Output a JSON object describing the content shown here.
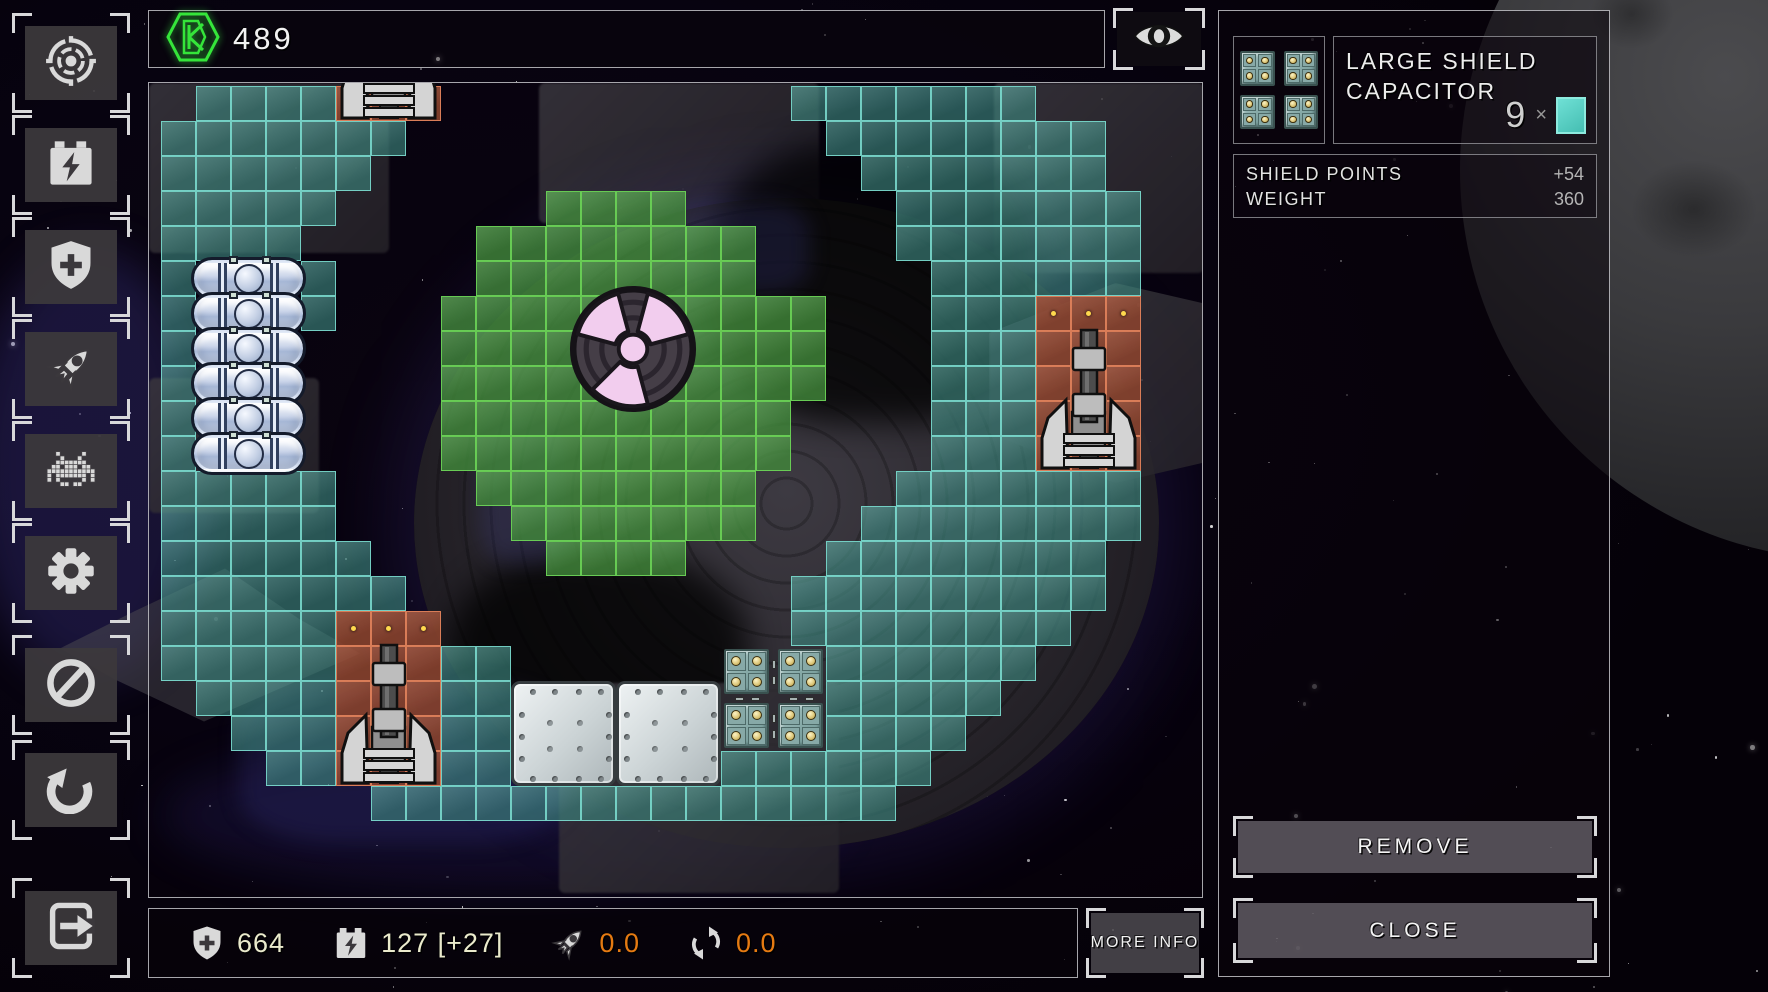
{
  "topbar": {
    "credits": "489",
    "credits_icon": "hex-credits-icon"
  },
  "viewbar": {
    "eye_icon": "eye-icon"
  },
  "sidebar": {
    "items": [
      {
        "id": "targeting",
        "icon": "target-icon"
      },
      {
        "id": "energy",
        "icon": "battery-icon"
      },
      {
        "id": "defense",
        "icon": "shield-plus-icon"
      },
      {
        "id": "engines",
        "icon": "rocket-icon"
      },
      {
        "id": "enemies",
        "icon": "invader-icon"
      },
      {
        "id": "settings",
        "icon": "gear-icon"
      },
      {
        "id": "restrict",
        "icon": "ban-icon"
      },
      {
        "id": "undo",
        "icon": "undo-icon"
      },
      {
        "id": "exit",
        "icon": "exit-icon"
      }
    ]
  },
  "grid": {
    "origin_x": 160,
    "origin_y": 85,
    "cell": 35,
    "legend": {
      "T": "shield-capacitor-cell",
      "G": "reactor-cell",
      "O": "weapon-cell",
      "F": "fuel-tank-slot",
      "A": "armor-slot",
      "C": "capacitor-slot",
      ".": "empty"
    },
    "rows": [
      ".TTTTOOO..........TTTTTTT...",
      "TTTTTTT............TTTTTTTT.",
      "TTTTTT..............TTTTTTT.",
      "TTTTT......GGGG......TTTTTTT",
      "TTTT.....GGGGGGGG....TTTTTTT",
      "TFFFT....GGGGGGGG.....TTTTTT",
      "TFFFT...GGGGGGGGGGG...TTTOOO",
      "TFFF....GGGGGGGGGGG...TTTOOO",
      "TFFF....GGGGGGGGGGG...TTTOOO",
      "TFFF....GGGGGGGGGG....TTTOOO",
      "TFFF....GGGGGGGGGG....TTTOOO",
      "TTTTT....GGGGGGGG....TTTTTTT",
      "TTTTT.....GGGGGGG...TTTTTTTT",
      "TTTTTT.....GGGG....TTTTTTTT.",
      "TTTTTTT...........TTTTTTTTT.",
      "TTTTTOOO..........TTTTTTTT..",
      "TTTTTOOOTT......CCCTTTTTT...",
      ".TTTTOOOTTAAAAAACCCTTTTT....",
      "..TTTOOOTTAAAAAACCCTTTT.....",
      "...TTOOOTTAAAAAATTTTTT......",
      "......TTTTTTTTTTTTTTT......."
    ],
    "modules": [
      {
        "type": "fuel-tank",
        "col": 1,
        "row": 5,
        "w": 3,
        "h": 1
      },
      {
        "type": "fuel-tank",
        "col": 1,
        "row": 6,
        "w": 3,
        "h": 1
      },
      {
        "type": "fuel-tank",
        "col": 1,
        "row": 7,
        "w": 3,
        "h": 1
      },
      {
        "type": "fuel-tank",
        "col": 1,
        "row": 8,
        "w": 3,
        "h": 1
      },
      {
        "type": "fuel-tank",
        "col": 1,
        "row": 9,
        "w": 3,
        "h": 1
      },
      {
        "type": "fuel-tank",
        "col": 1,
        "row": 10,
        "w": 3,
        "h": 1
      },
      {
        "type": "cannon",
        "col": 5,
        "row": -4,
        "w": 3,
        "h": 5,
        "clipped": true,
        "dots": false
      },
      {
        "type": "cannon",
        "col": 25,
        "row": 6,
        "w": 3,
        "h": 5,
        "clipped": false,
        "dots": true
      },
      {
        "type": "cannon",
        "col": 5,
        "row": 15,
        "w": 3,
        "h": 5,
        "clipped": false,
        "dots": true
      },
      {
        "type": "armor-plate",
        "col": 10,
        "row": 17,
        "w": 3,
        "h": 3
      },
      {
        "type": "armor-plate",
        "col": 13,
        "row": 17,
        "w": 3,
        "h": 3
      },
      {
        "type": "shield-capacitor",
        "col": 16,
        "row": 16,
        "w": 3,
        "h": 3
      },
      {
        "type": "reactor-core",
        "cx": 632,
        "cy": 348,
        "d": 130
      }
    ]
  },
  "bottombar": {
    "stats": [
      {
        "icon": "shield-plus-icon",
        "value": "664",
        "color": "cream"
      },
      {
        "icon": "battery-icon",
        "value": "127 [+27]",
        "color": "cream"
      },
      {
        "icon": "rocket-icon",
        "value": "0.0",
        "color": "orange"
      },
      {
        "icon": "rotate-icon",
        "value": "0.0",
        "color": "orange"
      }
    ],
    "more_info_label": "MORE INFO"
  },
  "item_panel": {
    "title": "LARGE SHIELD CAPACITOR",
    "item_icon": "shield-capacitor-icon",
    "count": "9",
    "count_unit": "×",
    "stats": [
      {
        "label": "SHIELD POINTS",
        "value": "+54"
      },
      {
        "label": "WEIGHT",
        "value": "360"
      }
    ],
    "remove_label": "REMOVE",
    "close_label": "CLOSE"
  },
  "colors": {
    "teal_fill": "rgba(72,158,148,0.60)",
    "teal_border": "rgba(126,225,212,0.85)",
    "green_fill": "rgba(74,156,66,0.78)",
    "green_border": "rgba(108,212,86,0.9)",
    "orange_fill": "rgba(158,77,52,0.88)",
    "orange_border": "rgba(226,131,92,0.9)",
    "accent_green": "#35e53a",
    "value_cream": "#eaeacc",
    "value_orange": "#e57a12",
    "swatch_teal": "#4fd2c6"
  }
}
